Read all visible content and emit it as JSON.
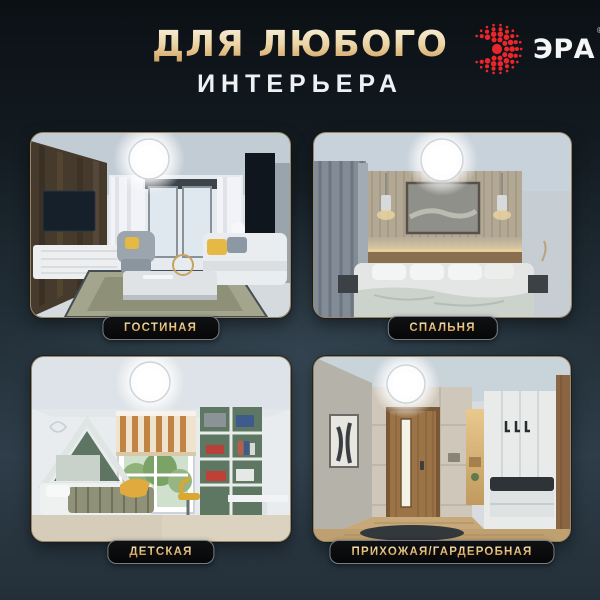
{
  "header": {
    "title_line1": "ДЛЯ ЛЮБОГО",
    "title_line2": "ИНТЕРЬЕРА"
  },
  "brand": {
    "name": "ЭРА",
    "registered_mark": "®"
  },
  "cards": [
    {
      "label": "ГОСТИНАЯ",
      "scene": "living-room"
    },
    {
      "label": "СПАЛЬНЯ",
      "scene": "bedroom"
    },
    {
      "label": "ДЕТСКАЯ",
      "scene": "kids-room"
    },
    {
      "label": "ПРИХОЖАЯ/ГАРДЕРОБНАЯ",
      "scene": "hallway-wardrobe"
    }
  ],
  "colors": {
    "background_top": "#0b1014",
    "background_mid": "#2b3944",
    "background_bottom": "#232f38",
    "title_gold": "#e3bf7d",
    "subtitle_white": "#eef1f3",
    "brand_red": "#e8262c",
    "card_border": "#9a8660",
    "badge_background": "#0a0a0b",
    "badge_text_gold": "#e0b468"
  }
}
